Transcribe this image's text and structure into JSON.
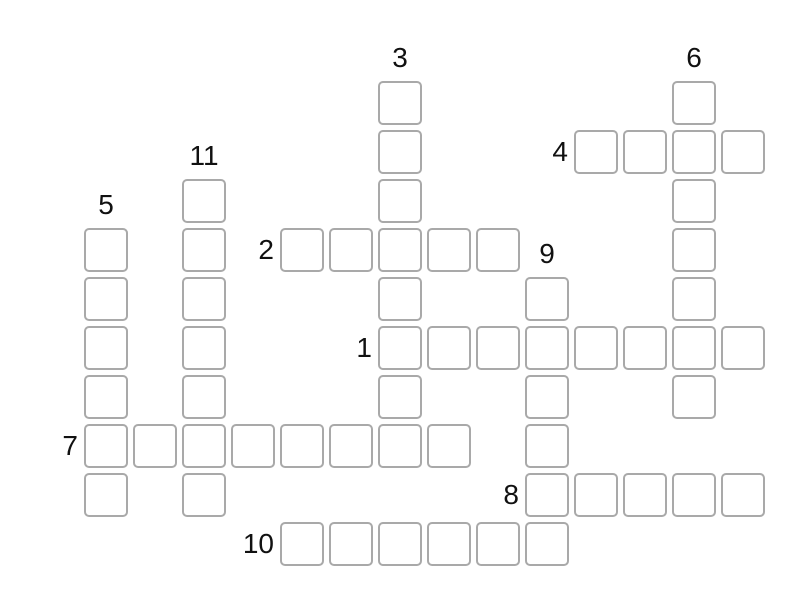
{
  "page": {
    "background_color": "#ffffff"
  },
  "puzzle": {
    "type": "crossword-grid",
    "state": "empty",
    "cell_fill_color": "#ffffff",
    "cell_border_color": "#a9a9a9",
    "number_color": "#111111",
    "entries": [
      {
        "number": "1",
        "direction": "across",
        "row": 5,
        "col": 6,
        "length": 8
      },
      {
        "number": "2",
        "direction": "across",
        "row": 3,
        "col": 4,
        "length": 5
      },
      {
        "number": "3",
        "direction": "down",
        "row": 0,
        "col": 6,
        "length": 8
      },
      {
        "number": "4",
        "direction": "across",
        "row": 1,
        "col": 10,
        "length": 4
      },
      {
        "number": "5",
        "direction": "down",
        "row": 3,
        "col": 0,
        "length": 6
      },
      {
        "number": "6",
        "direction": "down",
        "row": 0,
        "col": 12,
        "length": 7
      },
      {
        "number": "7",
        "direction": "across",
        "row": 7,
        "col": 0,
        "length": 8
      },
      {
        "number": "8",
        "direction": "across",
        "row": 8,
        "col": 9,
        "length": 5
      },
      {
        "number": "9",
        "direction": "down",
        "row": 4,
        "col": 9,
        "length": 6
      },
      {
        "number": "10",
        "direction": "across",
        "row": 9,
        "col": 4,
        "length": 6
      },
      {
        "number": "11",
        "direction": "down",
        "row": 2,
        "col": 2,
        "length": 7
      }
    ]
  }
}
